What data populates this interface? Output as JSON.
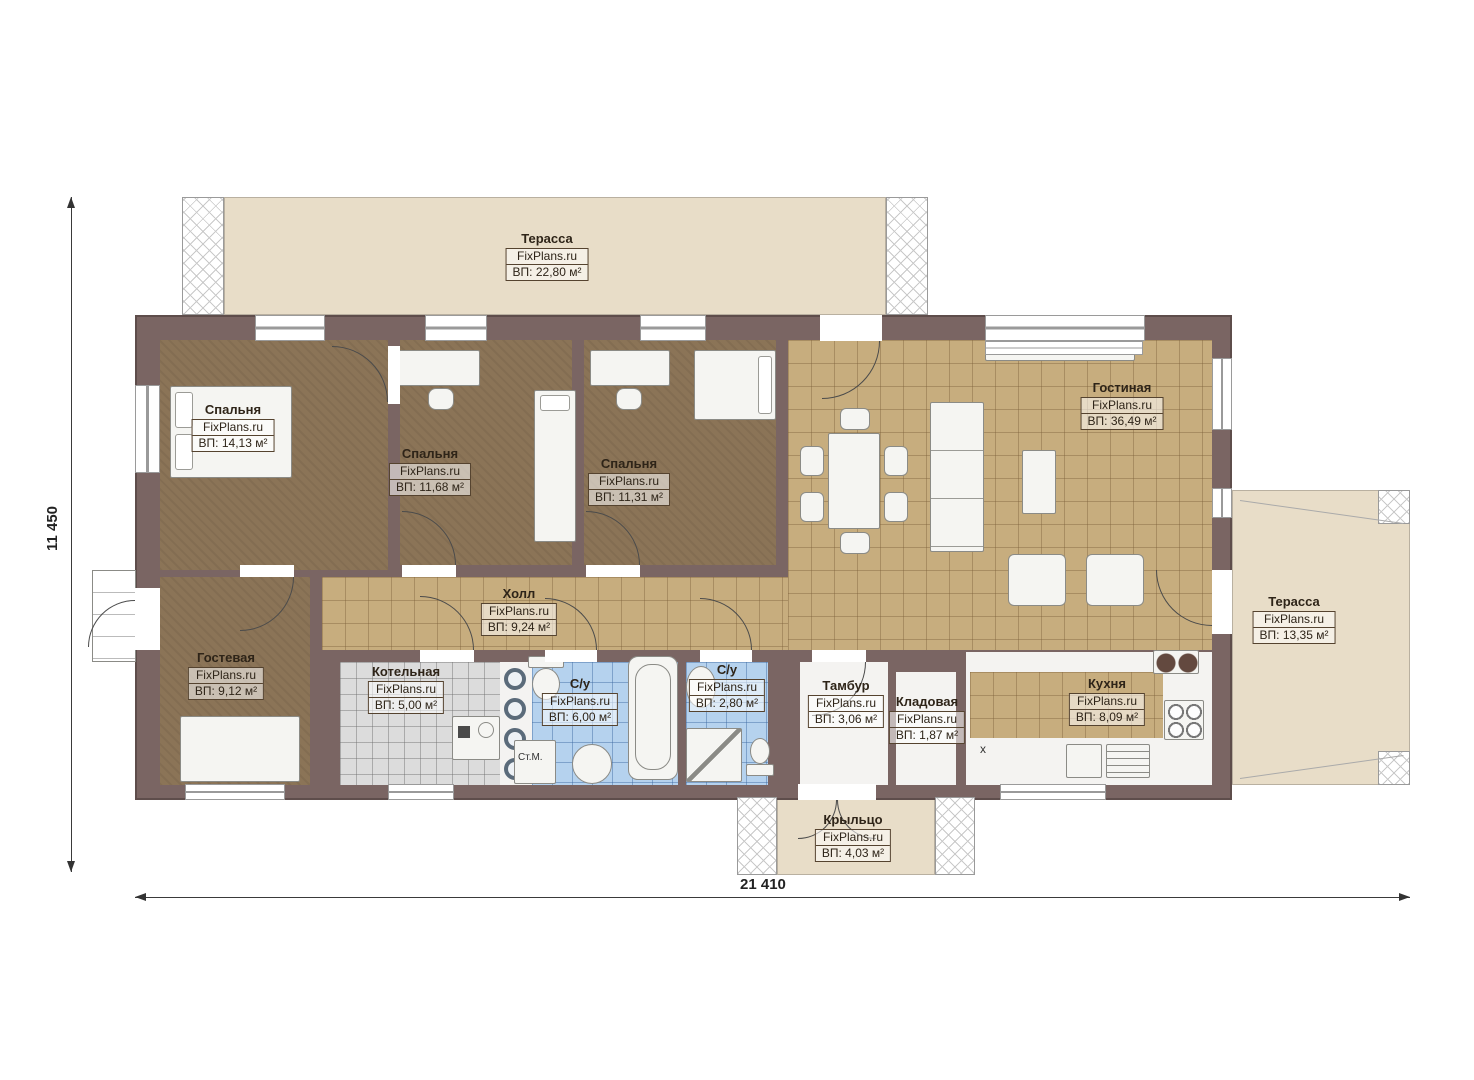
{
  "rooms": [
    {
      "name": "Терасса",
      "brand": "FixPlans.ru",
      "area": "ВП: 22,80 м²"
    },
    {
      "name": "Спальня",
      "brand": "FixPlans.ru",
      "area": "ВП: 14,13 м²"
    },
    {
      "name": "Спальня",
      "brand": "FixPlans.ru",
      "area": "ВП: 11,68 м²"
    },
    {
      "name": "Спальня",
      "brand": "FixPlans.ru",
      "area": "ВП: 11,31 м²"
    },
    {
      "name": "Гостиная",
      "brand": "FixPlans.ru",
      "area": "ВП: 36,49 м²"
    },
    {
      "name": "Холл",
      "brand": "FixPlans.ru",
      "area": "ВП: 9,24 м²"
    },
    {
      "name": "Гостевая",
      "brand": "FixPlans.ru",
      "area": "ВП: 9,12 м²"
    },
    {
      "name": "Котельная",
      "brand": "FixPlans.ru",
      "area": "ВП: 5,00 м²"
    },
    {
      "name": "С/у",
      "brand": "FixPlans.ru",
      "area": "ВП: 6,00 м²"
    },
    {
      "name": "С/у",
      "brand": "FixPlans.ru",
      "area": "ВП: 2,80 м²"
    },
    {
      "name": "Тамбур",
      "brand": "FixPlans.ru",
      "area": "ВП: 3,06 м²"
    },
    {
      "name": "Кладовая",
      "brand": "FixPlans.ru",
      "area": "ВП: 1,87 м²"
    },
    {
      "name": "Кухня",
      "brand": "FixPlans.ru",
      "area": "ВП: 8,09 м²"
    },
    {
      "name": "Терасса",
      "brand": "FixPlans.ru",
      "area": "ВП: 13,35 м²"
    },
    {
      "name": "Крыльцо",
      "brand": "FixPlans.ru",
      "area": "ВП: 4,03 м²"
    }
  ],
  "dimensions": {
    "height_label": "11 450",
    "width_label": "21 410"
  },
  "annotations": {
    "washing_machine": "Ст.М.",
    "kitchen_mark": "x"
  },
  "colors": {
    "wall": "#7a6563",
    "tile_tan": "#c7ad7e",
    "carpet_brown": "#8b7457",
    "tile_blue": "#b5d2ee",
    "tile_gray": "#dcdcdc",
    "terrace_beige": "#e8ddc8",
    "background": "#ffffff"
  }
}
